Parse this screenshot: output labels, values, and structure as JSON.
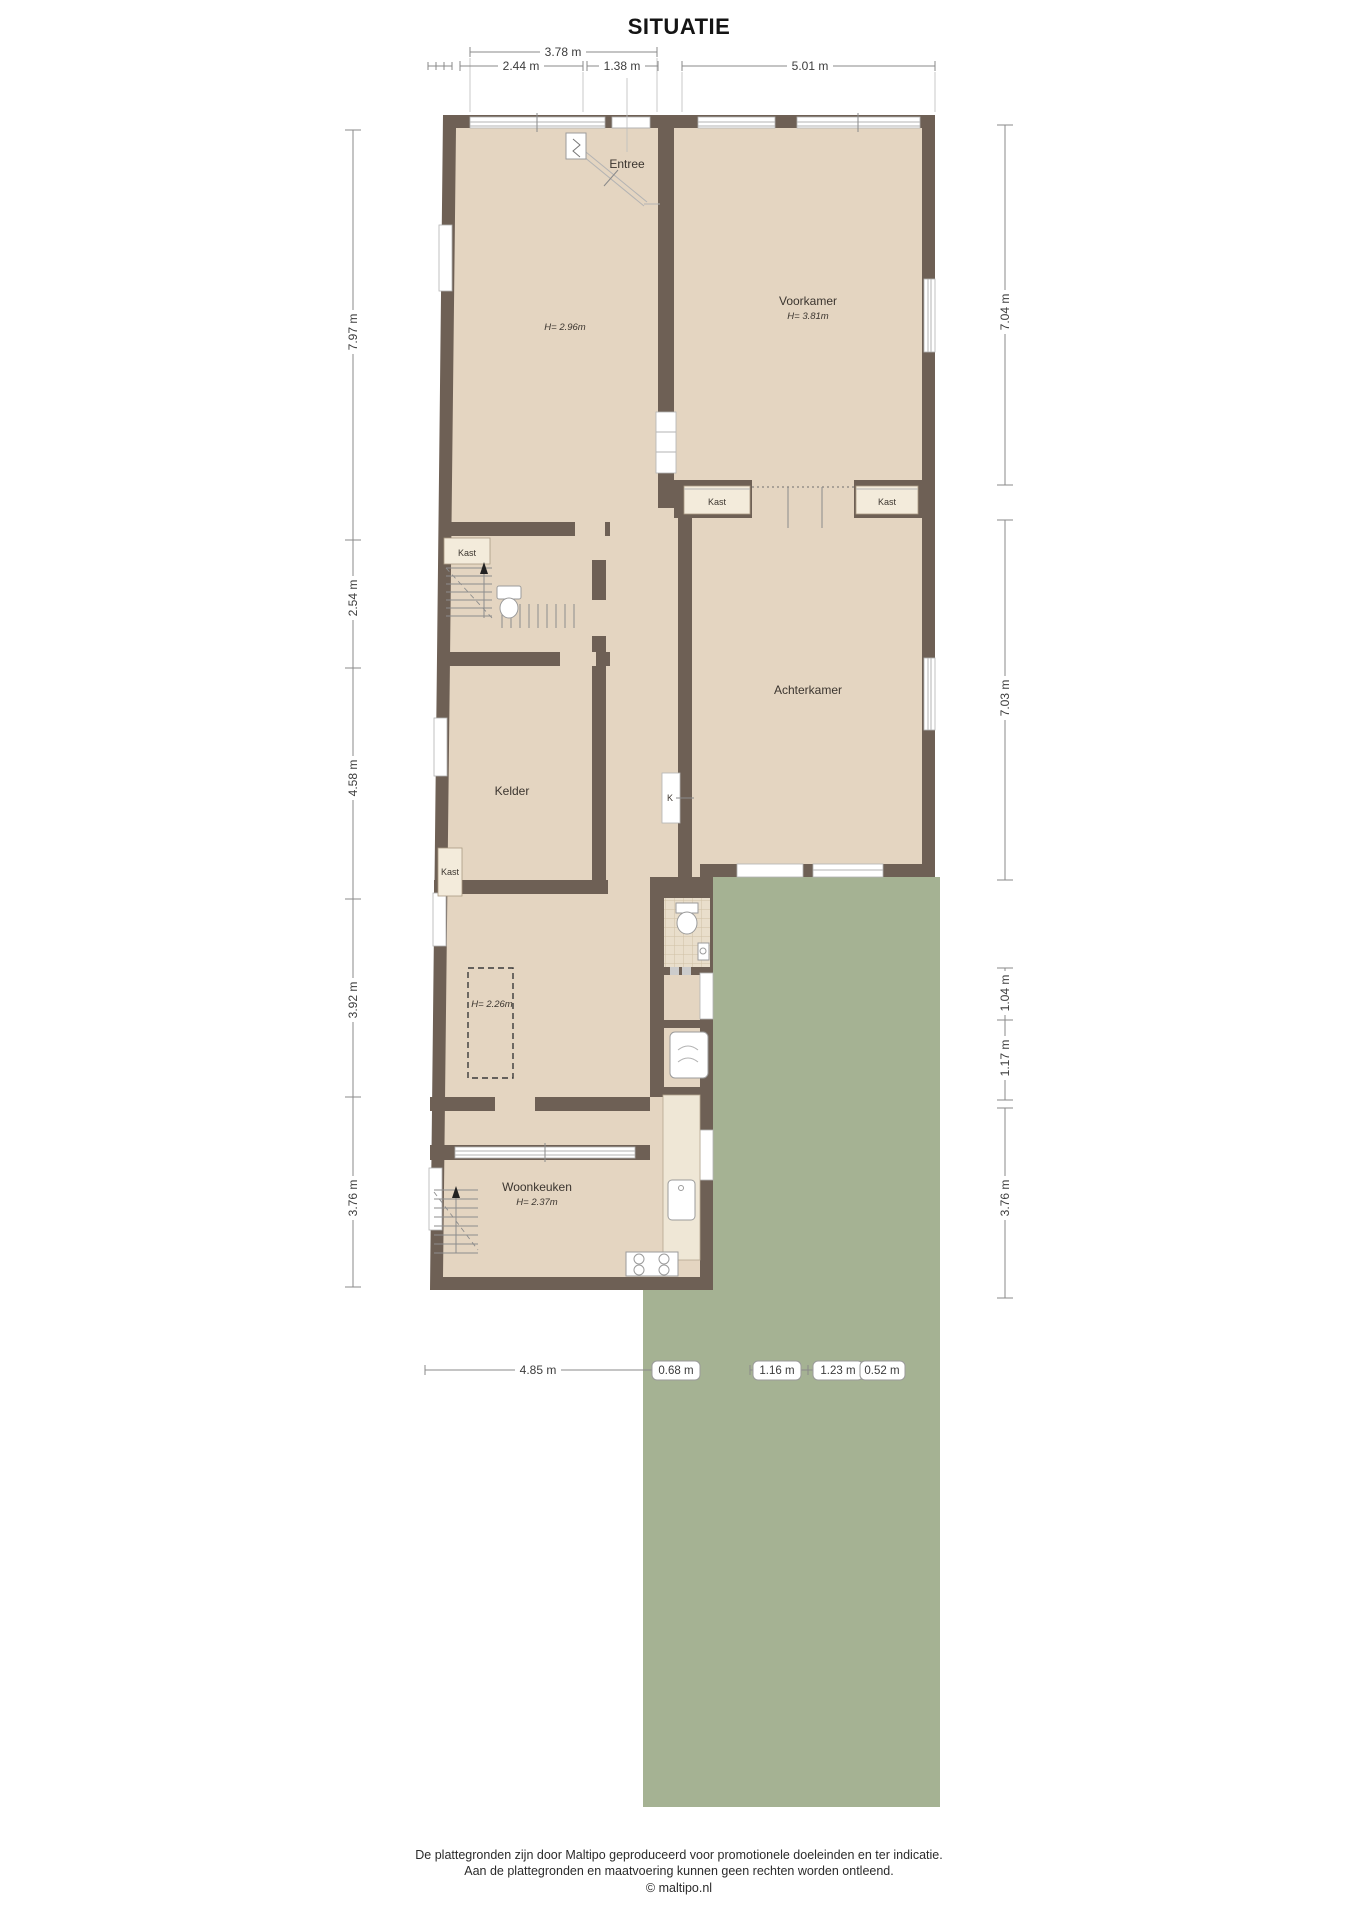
{
  "title": "SITUATIE",
  "rooms": {
    "entree": {
      "label": "Entree"
    },
    "front_room": {
      "height": "H= 2.96m"
    },
    "voorkamer": {
      "label": "Voorkamer",
      "height": "H= 3.81m"
    },
    "achterkamer": {
      "label": "Achterkamer"
    },
    "kelder": {
      "label": "Kelder"
    },
    "zone_low": {
      "height": "H= 2.26m"
    },
    "woonkeuken": {
      "label": "Woonkeuken",
      "height": "H= 2.37m"
    }
  },
  "closets": {
    "hall": "Kast",
    "ensuite_left": "Kast",
    "ensuite_right": "Kast",
    "kelder": "Kast",
    "meter": "K"
  },
  "dimensions": {
    "top": [
      "3.78 m",
      "2.44 m",
      "1.38 m",
      "5.01 m"
    ],
    "left": [
      "7.97 m",
      "2.54 m",
      "4.58 m",
      "3.92 m",
      "3.76 m"
    ],
    "right": [
      "7.04 m",
      "7.03 m",
      "1.04 m",
      "1.17 m",
      "3.76 m"
    ],
    "bottom": [
      "4.85 m",
      "0.68 m",
      "1.16 m",
      "1.23 m",
      "0.52 m"
    ]
  },
  "colors": {
    "wall": "#6e6055",
    "floor": "#e4d5c1",
    "closet": "#f3ebdb",
    "garden": "#a5b293",
    "tile": "#cfc0a4",
    "dim_text": "#3c3c3c"
  },
  "footer": {
    "line1": "De plattegronden zijn door Maltipo geproduceerd voor promotionele doeleinden en ter indicatie.",
    "line2": "Aan de plattegronden en maatvoering kunnen geen rechten worden ontleend.",
    "line3": "© maltipo.nl"
  }
}
